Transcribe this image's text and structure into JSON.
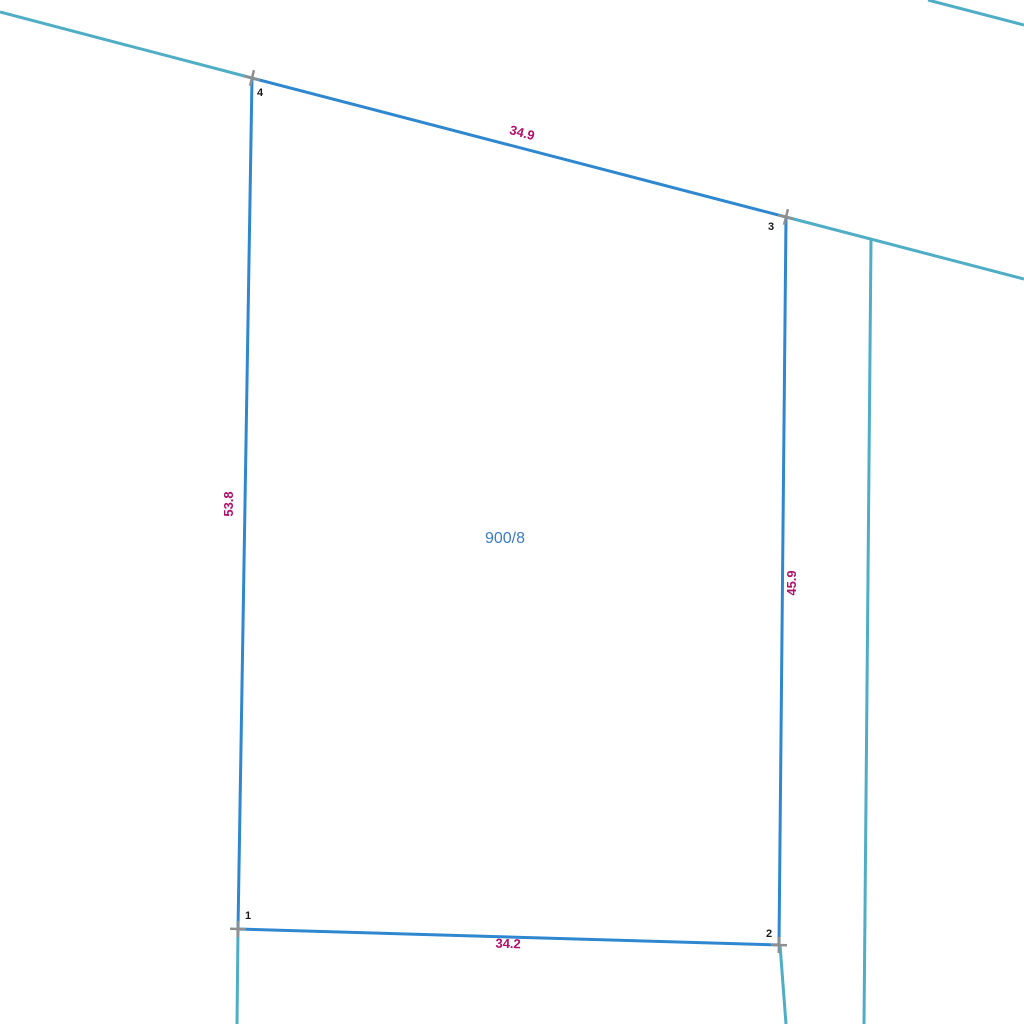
{
  "map": {
    "background": "#ffffff",
    "colors": {
      "parcel_edge": "#2e87cf",
      "adjacent_boundary": "#4fadc6",
      "survey_marker": "#8f8f8f",
      "dimension_text": "#b0106c",
      "parcel_text": "#3b7cc4",
      "vertex_text": "#1a1a1a"
    },
    "stroke_widths": {
      "parcel_edge": 3,
      "adjacent_boundary": 3,
      "survey_marker": 2.5
    },
    "parcel": {
      "number": "900/8",
      "label_x": 505,
      "label_y": 543,
      "vertices": [
        {
          "n": "4",
          "x": 252,
          "y": 78,
          "label_dx": 8,
          "label_dy": 18,
          "marker_rot": 14
        },
        {
          "n": "3",
          "x": 786,
          "y": 217,
          "label_dx": -15,
          "label_dy": 13,
          "marker_rot": 14
        },
        {
          "n": "2",
          "x": 779,
          "y": 945,
          "label_dx": -10,
          "label_dy": -8,
          "marker_rot": 2
        },
        {
          "n": "1",
          "x": 238,
          "y": 929,
          "label_dx": 10,
          "label_dy": -10,
          "marker_rot": 2
        }
      ]
    },
    "dimension_labels": [
      {
        "text": "34.9",
        "x": 521,
        "y": 137,
        "rotation": 14.6
      },
      {
        "text": "45.9",
        "x": 796,
        "y": 583,
        "rotation": -90
      },
      {
        "text": "53.8",
        "x": 233,
        "y": 504,
        "rotation": -90
      },
      {
        "text": "34.2",
        "x": 508,
        "y": 948,
        "rotation": 1.7
      }
    ],
    "adjacent_lines": [
      {
        "id": "road-line-left",
        "x1": 0,
        "y1": 12,
        "x2": 252,
        "y2": 78
      },
      {
        "id": "road-line-right",
        "x1": 786,
        "y1": 217,
        "x2": 1024,
        "y2": 279
      },
      {
        "id": "corner-line-topright",
        "x1": 928,
        "y1": 0,
        "x2": 1024,
        "y2": 25
      },
      {
        "id": "boundary-right-vertical",
        "x1": 871,
        "y1": 240,
        "x2": 864,
        "y2": 1024
      },
      {
        "id": "boundary-below-point1",
        "x1": 238,
        "y1": 929,
        "x2": 237,
        "y2": 1024
      },
      {
        "id": "boundary-below-point2",
        "x1": 780,
        "y1": 945,
        "x2": 786,
        "y2": 1024
      }
    ]
  }
}
